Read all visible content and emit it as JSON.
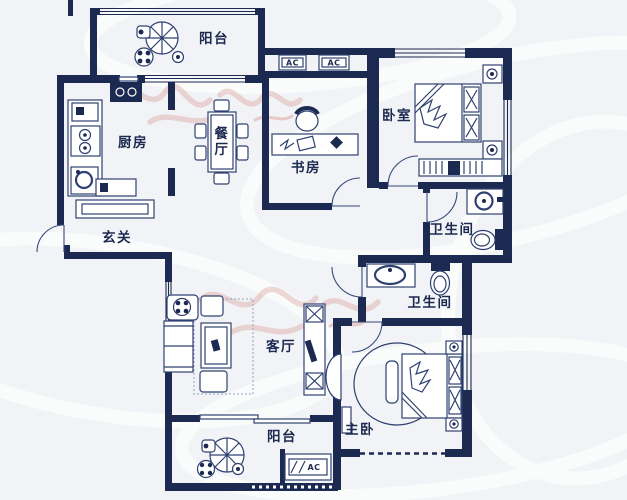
{
  "plan": {
    "rooms": [
      {
        "id": "balcony-top",
        "label": "阳台"
      },
      {
        "id": "kitchen",
        "label": "厨房"
      },
      {
        "id": "dining",
        "label": "餐厅",
        "chars": [
          "餐",
          "厅"
        ]
      },
      {
        "id": "study",
        "label": "书房"
      },
      {
        "id": "bedroom",
        "label": "卧室"
      },
      {
        "id": "bath-upper",
        "label": "卫生间"
      },
      {
        "id": "entry",
        "label": "玄关"
      },
      {
        "id": "bath-lower",
        "label": "卫生间"
      },
      {
        "id": "living",
        "label": "客厅"
      },
      {
        "id": "master-bedroom",
        "label": "主卧"
      },
      {
        "id": "balcony-bottom",
        "label": "阳台"
      }
    ],
    "equipment": {
      "ac_label": "AC"
    },
    "colors": {
      "wall": "#1c2950",
      "furniture_line": "#2e4170",
      "background": "#f2f3f6",
      "watermark": "#dcaaa4"
    }
  }
}
